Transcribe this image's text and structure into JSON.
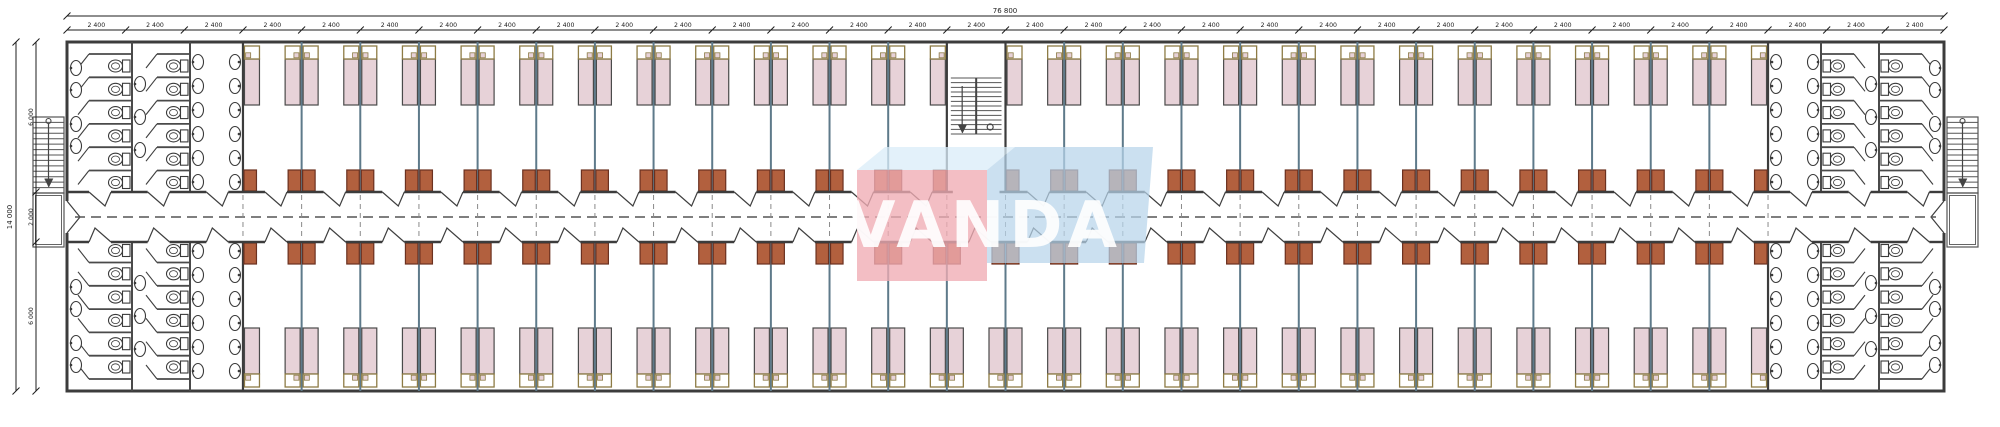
{
  "drawing": {
    "type": "architectural-floor-plan",
    "description": "Long dormitory block floor plan with central corridor, twin-bed rooms, end washrooms and staircases",
    "dimensions": {
      "horizontal": {
        "total": "76 800",
        "bay": "2 400",
        "bay_count": 32
      },
      "vertical": {
        "total": "14 000",
        "segments": [
          "6 000",
          "2 000",
          "6 000"
        ]
      }
    },
    "watermark": {
      "text": "VANDA",
      "front_color": "#f0acb4",
      "side_color": "#b7d4ea",
      "roof_color": "#d9ecf8",
      "letter_color": "#ffffff"
    },
    "colors": {
      "background": "#ffffff",
      "wall": "#3c3c3c",
      "partition": "#5e7a8a",
      "fixture": "#3a3a3a",
      "stall": "#4a4a4a",
      "dash": "#555555",
      "bed_fill": "#e7d2d8",
      "bed_stroke": "#4a4a4a",
      "headboard": "#8d7b45",
      "desk_fill": "#b2603e",
      "desk_stroke": "#6b3120"
    },
    "counts": {
      "room_bays_top": 25,
      "room_bays_bottom": 26,
      "bathroom_bays_per_end": 3,
      "toilet_banks_per_bathroom": 2,
      "toilets_per_bank": 6,
      "beds_per_room": 2,
      "central_stair_bays": 1,
      "external_stairs": 2
    }
  }
}
